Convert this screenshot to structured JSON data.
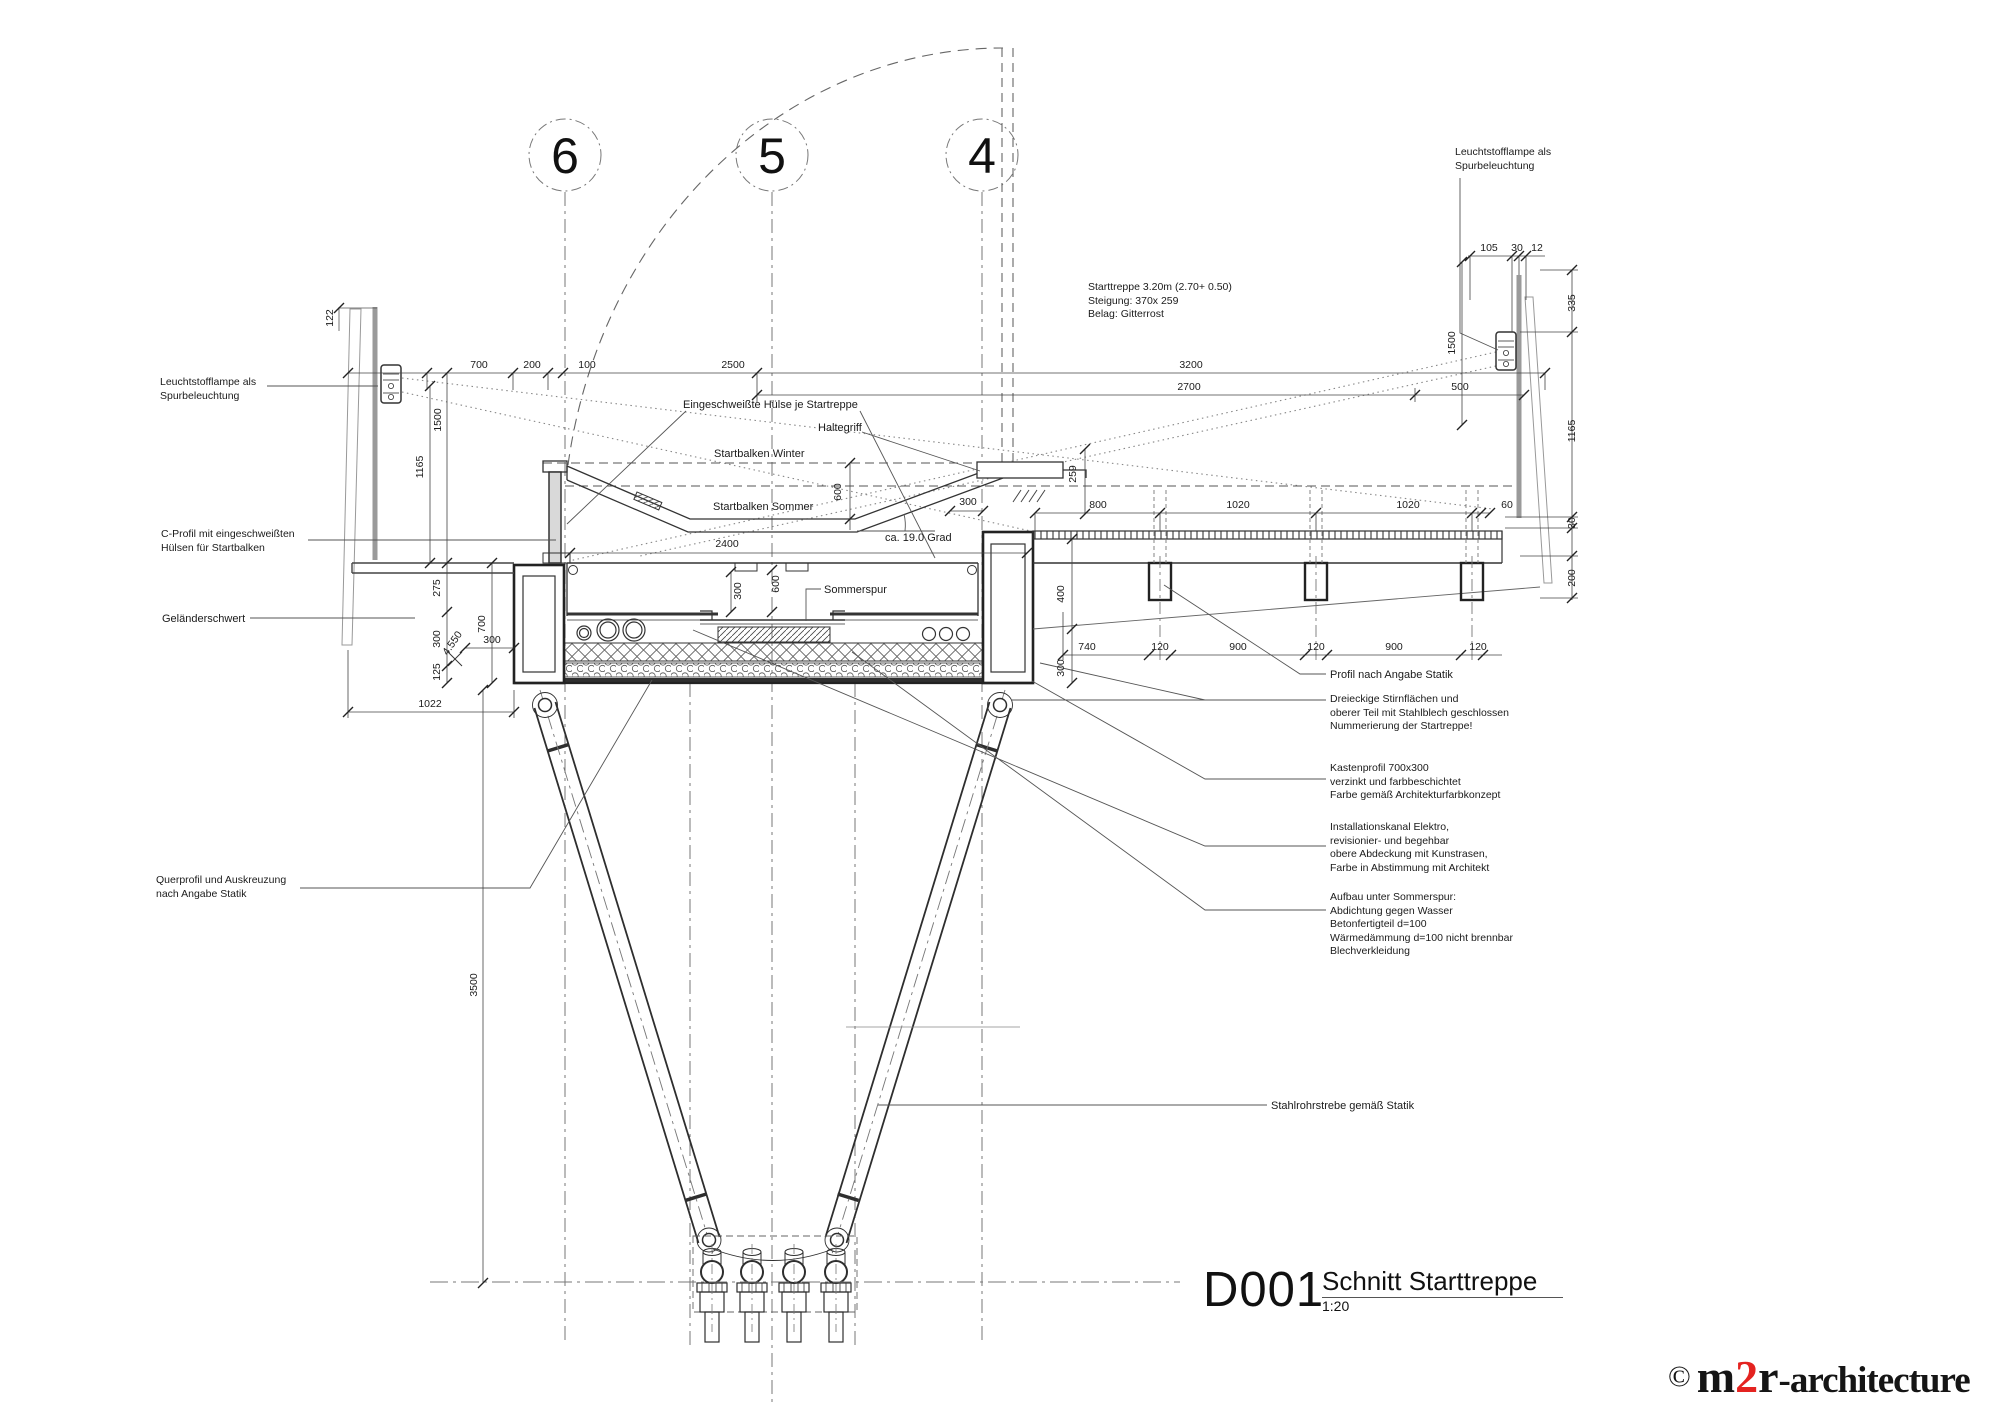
{
  "title_block": {
    "code": "D001",
    "title": "Schnitt Starttreppe",
    "scale": "1:20"
  },
  "logo": {
    "copyright": "©",
    "m": "m",
    "two": "2",
    "r": "r",
    "suffix": "-architecture",
    "red": "#e42320"
  },
  "grids": [
    "6",
    "5",
    "4"
  ],
  "labels": {
    "lamp": {
      "line1": "Leuchtstofflampe als",
      "line2": "Spurbeleuchtung"
    },
    "stair_info": {
      "line1": "Starttreppe 3.20m (2.70+ 0.50)",
      "line2": "Steigung: 370x 259",
      "line3": "Belag: Gitterrost"
    },
    "huelse": "Eingeschweißte Hülse je Startreppe",
    "haltegriff": "Haltegriff",
    "balken_winter": "Startbalken Winter",
    "balken_sommer": "Startbalken Sommer",
    "angle": "ca. 19.0 Grad",
    "sommerspur": "Sommerspur",
    "c_profil": {
      "line1": "C-Profil mit eingeschweißten",
      "line2": "Hülsen für Startbalken"
    },
    "gelaenderschwert": "Geländerschwert",
    "querprofil": {
      "line1": "Querprofil und Auskreuzung",
      "line2": "nach Angabe Statik"
    },
    "profil_statik": "Profil nach Angabe Statik",
    "dreieckige": {
      "line1": "Dreieckige Stirnflächen und",
      "line2": "oberer Teil mit Stahlblech geschlossen",
      "line3": "Nummerierung der Startreppe!"
    },
    "kastenprofil": {
      "line1": "Kastenprofil 700x300",
      "line2": "verzinkt und farbbeschichtet",
      "line3": "Farbe gemäß Architekturfarbkonzept"
    },
    "installationskanal": {
      "line1": "Installationskanal Elektro,",
      "line2": "revisionier- und begehbar",
      "line3": "obere Abdeckung mit Kunstrasen,",
      "line4": "Farbe in Abstimmung mit Architekt"
    },
    "aufbau": {
      "line1": "Aufbau unter Sommerspur:",
      "line2": "Abdichtung gegen Wasser",
      "line3": "Betonfertigteil d=100",
      "line4": "Wärmedämmung d=100 nicht brennbar",
      "line5": "Blechverkleidung"
    },
    "stahlrohr": "Stahlrohrstrebe gemäß Statik"
  },
  "dims": {
    "d700a": "700",
    "d200": "200",
    "d100": "100",
    "d2500": "2500",
    "d3200": "3200",
    "d2700": "2700",
    "d500": "500",
    "d105": "105",
    "d30a": "30",
    "d12": "12",
    "d122": "122",
    "d1500a": "1500",
    "d1165a": "1165",
    "d275": "275",
    "d300a": "300",
    "d125": "125",
    "d700b": "700",
    "d300b": "300",
    "d1022": "1022",
    "d2400": "2400",
    "d300c": "300",
    "d600a": "600",
    "d600b": "600",
    "d259": "259",
    "d300d": "300",
    "d800": "800",
    "d1020a": "1020",
    "d1020b": "1020",
    "d60": "60",
    "d740": "740",
    "d120a": "120",
    "d900a": "900",
    "d120b": "120",
    "d900b": "900",
    "d120c": "120",
    "d400": "400",
    "d300e": "300",
    "d1500b": "1500",
    "d335": "335",
    "d1165b": "1165",
    "d30b": "30",
    "d200b": "200",
    "d3500": "3500",
    "level": "4.550"
  }
}
